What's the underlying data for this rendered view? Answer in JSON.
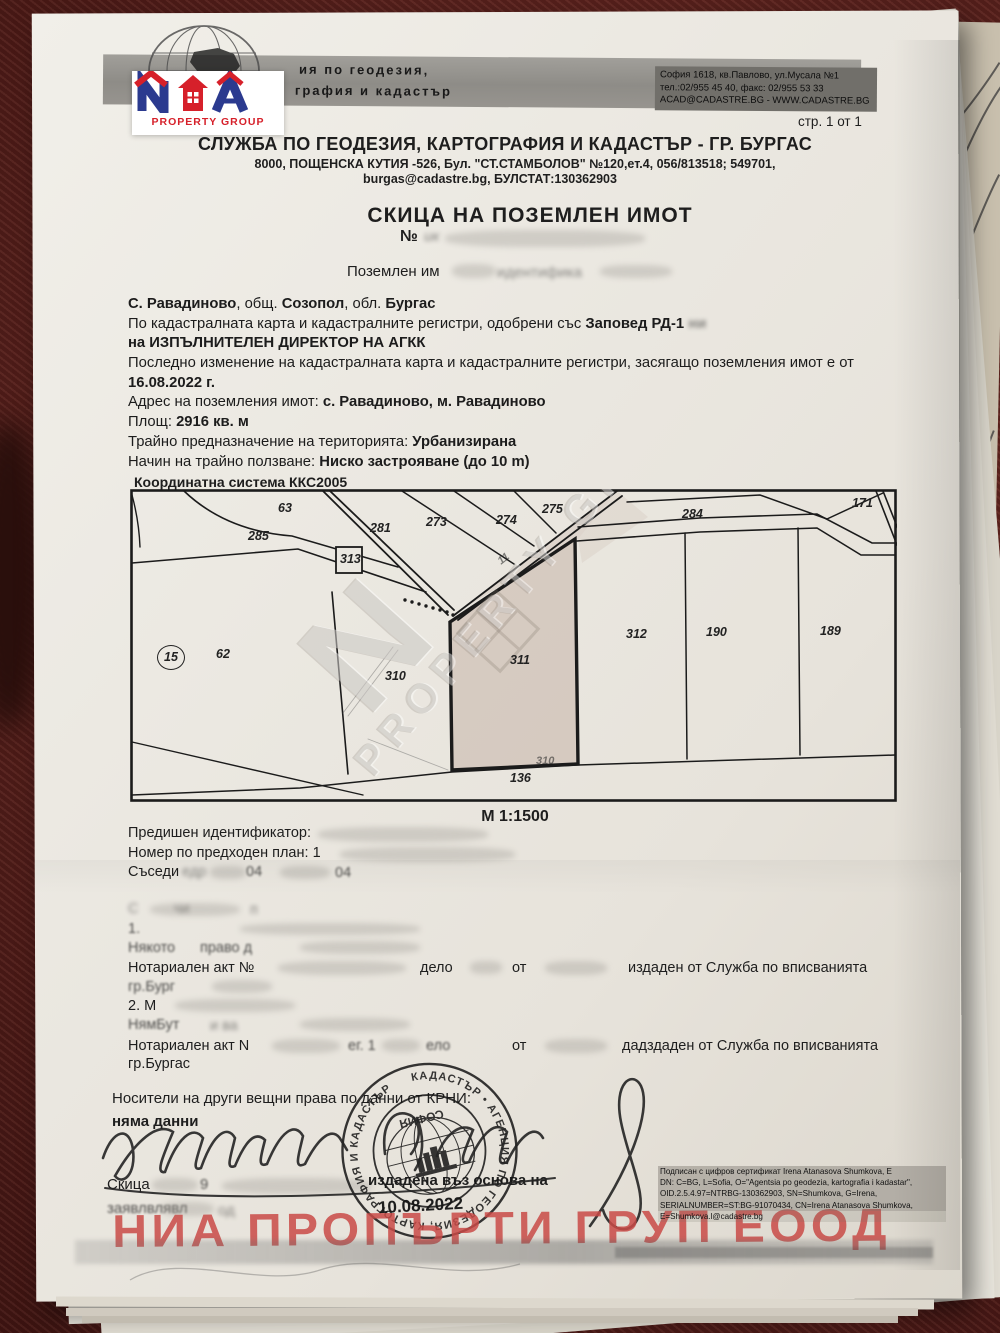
{
  "letterhead": {
    "banner_left_lines": [
      "ия по геодезия,",
      "графия и кадастър"
    ],
    "banner_right_lines": [
      "София 1618, кв.Павлово, ул.Мусала №1",
      "тел.:02/955 45 40, факс: 02/955 53 33",
      "ACAD@CADASTRE.BG - WWW.CADASTRE.BG"
    ],
    "page_indicator": "стр. 1 от 1",
    "office_title": "СЛУЖБА ПО ГЕОДЕЗИЯ, КАРТОГРАФИЯ И КАДАСТЪР - ГР. БУРГАС",
    "office_address": "8000, ПОЩЕНСКА КУТИЯ -526, Бул. \"СТ.СТАМБОЛОВ\" №120,ет.4, 056/813518; 549701,",
    "office_email_line": "burgas@cadastre.bg, БУЛСТАТ:130362903"
  },
  "nia_logo": {
    "subtitle": "PROPERTY GROUP",
    "blue": "#2b3a8f",
    "red": "#d6202a"
  },
  "document": {
    "title": "СКИЦА НА ПОЗЕМЛЕН ИМОТ",
    "number_prefix": "№",
    "number_fragment": "ик",
    "subtitle_prefix": "Поземлен им",
    "subtitle_blurred": "идентифика"
  },
  "property": {
    "lines": [
      [
        {
          "t": "С. Равадиново",
          "b": 1
        },
        {
          "t": ", общ. ",
          "b": 0
        },
        {
          "t": "Созопол",
          "b": 1
        },
        {
          "t": ", обл. ",
          "b": 0
        },
        {
          "t": "Бургас",
          "b": 1
        }
      ],
      [
        {
          "t": "По кадастралната карта и кадастралните регистри, одобрени със ",
          "b": 0
        },
        {
          "t": "Заповед РД-1",
          "b": 1
        },
        {
          "t": "  ",
          "b": 0
        },
        {
          "t": "ни",
          "b": 1,
          "blur": 1
        }
      ],
      [
        {
          "t": "на ИЗПЪЛНИТЕЛЕН ДИРЕКТОР НА АГКК",
          "b": 1
        }
      ],
      [
        {
          "t": "Последно изменение на кадастралната карта и кадастралните регистри, засягащо поземления имот е от",
          "b": 0
        }
      ],
      [
        {
          "t": "16.08.2022 г.",
          "b": 1
        }
      ],
      [
        {
          "t": "Адрес на поземления имот: ",
          "b": 0
        },
        {
          "t": "с. Равадиново, м. Равадиново",
          "b": 1
        }
      ],
      [
        {
          "t": "Площ: ",
          "b": 0
        },
        {
          "t": "2916 кв. м",
          "b": 1
        }
      ],
      [
        {
          "t": "Трайно предназначение на територията: ",
          "b": 0
        },
        {
          "t": "Урбанизирана",
          "b": 1
        }
      ],
      [
        {
          "t": "Начин на трайно ползване: ",
          "b": 0
        },
        {
          "t": "Ниско застрояване (до 10 m)",
          "b": 1
        }
      ]
    ]
  },
  "map": {
    "coordinate_system": "Координатна система ККС2005",
    "scale": "М 1:1500",
    "subject_parcel": "311",
    "labels": [
      {
        "id": "63",
        "x": 148,
        "y": 12
      },
      {
        "id": "285",
        "x": 118,
        "y": 40
      },
      {
        "id": "281",
        "x": 240,
        "y": 32
      },
      {
        "id": "273",
        "x": 296,
        "y": 26
      },
      {
        "id": "274",
        "x": 366,
        "y": 24
      },
      {
        "id": "275",
        "x": 412,
        "y": 13
      },
      {
        "id": "284",
        "x": 552,
        "y": 18
      },
      {
        "id": "171",
        "x": 722,
        "y": 7
      },
      {
        "id": "313",
        "x": 210,
        "y": 63
      },
      {
        "id": "15",
        "x": 34,
        "y": 160,
        "circled": true
      },
      {
        "id": "62",
        "x": 86,
        "y": 158
      },
      {
        "id": "310",
        "x": 255,
        "y": 180
      },
      {
        "id": "311",
        "x": 380,
        "y": 164
      },
      {
        "id": "312",
        "x": 496,
        "y": 138
      },
      {
        "id": "190",
        "x": 576,
        "y": 136
      },
      {
        "id": "189",
        "x": 690,
        "y": 135
      },
      {
        "id": "136",
        "x": 380,
        "y": 282
      },
      {
        "id": "310",
        "x": 406,
        "y": 266,
        "faint": true
      },
      {
        "id": "11",
        "x": 368,
        "y": 64,
        "faint": true,
        "rot": -38
      }
    ]
  },
  "cadastre_notes": {
    "previous_identifier_label": "Предишен идентификатор:",
    "previous_plan_label": "Номер по предходен план: 1",
    "neighbours_label": "Съседи",
    "neighbours_blur": "едр",
    "neighbour_fragments": [
      "04",
      "04"
    ]
  },
  "owners_section": {
    "fragments": [
      {
        "t": "С",
        "x": 128,
        "y": 901,
        "blur": 2
      },
      {
        "t": "чи",
        "x": 174,
        "y": 901,
        "blur": 2
      },
      {
        "t": "п",
        "x": 250,
        "y": 902,
        "blur": 2
      },
      {
        "t": "1.",
        "x": 128,
        "y": 921,
        "blur": 1
      },
      {
        "t": "Някото",
        "x": 128,
        "y": 940,
        "blur": 1
      },
      {
        "t": "право д",
        "x": 200,
        "y": 940,
        "blur": 1
      },
      {
        "t": "Нотариален акт №",
        "x": 128,
        "y": 960
      },
      {
        "t": "дело",
        "x": 420,
        "y": 960
      },
      {
        "t": "от",
        "x": 512,
        "y": 960
      },
      {
        "t": "издаден от Служба по вписванията",
        "x": 628,
        "y": 960
      },
      {
        "t": "гр.Бург",
        "x": 128,
        "y": 979,
        "blur": 1
      },
      {
        "t": "2. М",
        "x": 128,
        "y": 998
      },
      {
        "t": "НямБут",
        "x": 128,
        "y": 1017,
        "blur": 1
      },
      {
        "t": "и ва",
        "x": 210,
        "y": 1018,
        "blur": 2
      },
      {
        "t": "Нотариален акт N",
        "x": 128,
        "y": 1038
      },
      {
        "t": "ег. 1",
        "x": 348,
        "y": 1038,
        "blur": 1
      },
      {
        "t": "ело",
        "x": 426,
        "y": 1038,
        "blur": 1
      },
      {
        "t": "от",
        "x": 512,
        "y": 1038
      },
      {
        "t": "дадздаден от Служба по вписванията",
        "x": 622,
        "y": 1038
      },
      {
        "t": "гр.Бургас",
        "x": 128,
        "y": 1056
      }
    ]
  },
  "certify": {
    "holders_line": "Носители на други вещни права по данни от КРНИ:",
    "no_data": "няма данни",
    "sketch_label": "Скица",
    "sketch_number_fragment": "9",
    "issued_fragment": "издадена въз основа на",
    "date": "10.08.2022",
    "application_fragment": "заявлвлявл",
    "application_fragment2": "од"
  },
  "stamp": {
    "ring_text": "КАДАСТЪР • АГЕНЦИЯ ПО ГЕОДЕЗИЯ, КАРТОГРАФИЯ И КАДАСТЪР",
    "center_text": "СОФИЯ"
  },
  "watermarks": {
    "map_watermark": "PROPERTY GROUP",
    "bottom_watermark": "НИА ПРОПЪРТИ ГРУП ЕООД",
    "red": "#c94a46"
  },
  "signature_certificate": {
    "lines": [
      "Подписан с цифров сертификат Irena Atanasova Shumkova, E",
      "DN: C=BG, L=Sofia, O=\"Agentsia po geodezia, kartografia i kadastar\",",
      "OID.2.5.4.97=NTRBG-130362903, SN=Shumkova, G=Irena,",
      "SERIALNUMBER=ST:BG-91070434, CN=Irena Atanasova Shumkova,",
      "E=Shumkova.l@cadastre.bg"
    ]
  }
}
